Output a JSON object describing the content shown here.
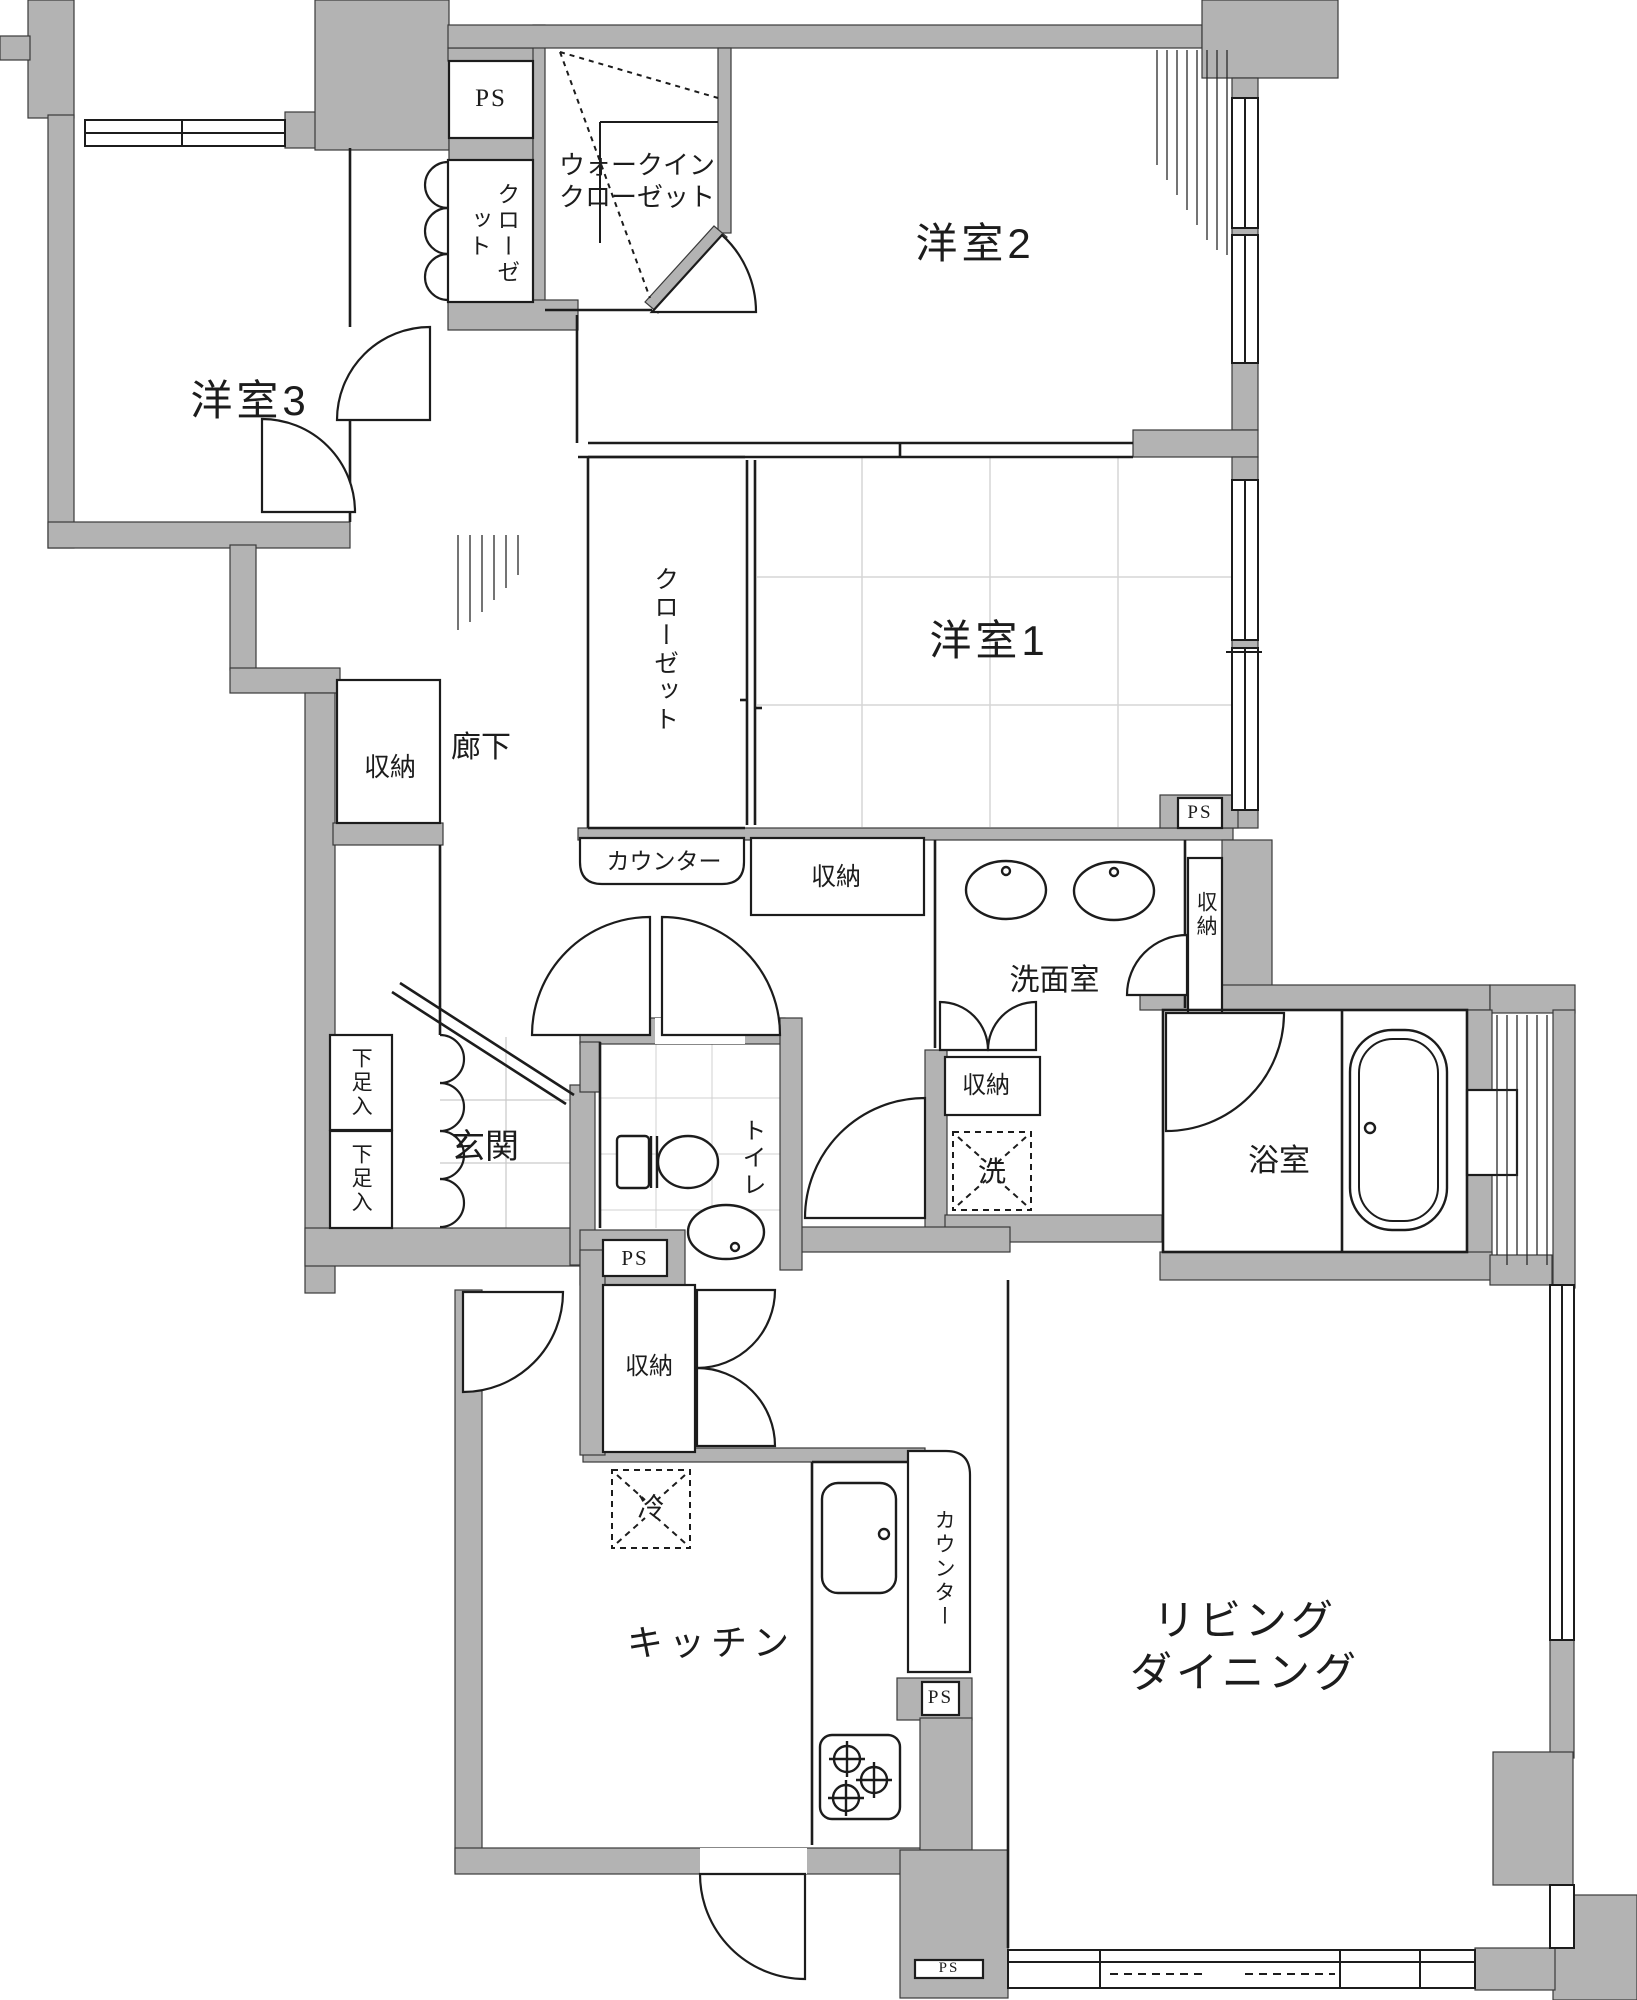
{
  "meta": {
    "type": "apartment-floor-plan",
    "language": "ja"
  },
  "colors": {
    "wall": "#b3b3b3",
    "line": "#1c1c1c",
    "grid_light": "#d6d6d6",
    "bg": "#ffffff"
  },
  "labels": {
    "ps": "PS",
    "yoshitsu1": "洋室1",
    "yoshitsu2": "洋室2",
    "yoshitsu3": "洋室3",
    "walk_in_closet": "ウォークイン\nクローゼット",
    "closet": "クローゼット",
    "shuno": "収納",
    "counter": "カウンター",
    "rouka": "廊下",
    "senmenshitsu": "洗面室",
    "yokushitsu": "浴室",
    "genkan": "玄関",
    "gesokuire": "下足入",
    "toire": "トイレ",
    "kitchen": "キッチン",
    "living_dining": "リビング\nダイニング",
    "washer": "洗",
    "fridge": "冷"
  },
  "counts": {
    "ps_boxes": 5,
    "shuno_storages": 6,
    "gesokuire_cabinets": 2,
    "counters": 2,
    "closets": 2,
    "walk_in_closets": 1
  },
  "fixtures": [
    "bathtub",
    "twin-wash-basins",
    "toilet",
    "toilet-hand-basin",
    "kitchen-sink",
    "stove-3-burner",
    "refrigerator-space",
    "washing-machine-space"
  ]
}
